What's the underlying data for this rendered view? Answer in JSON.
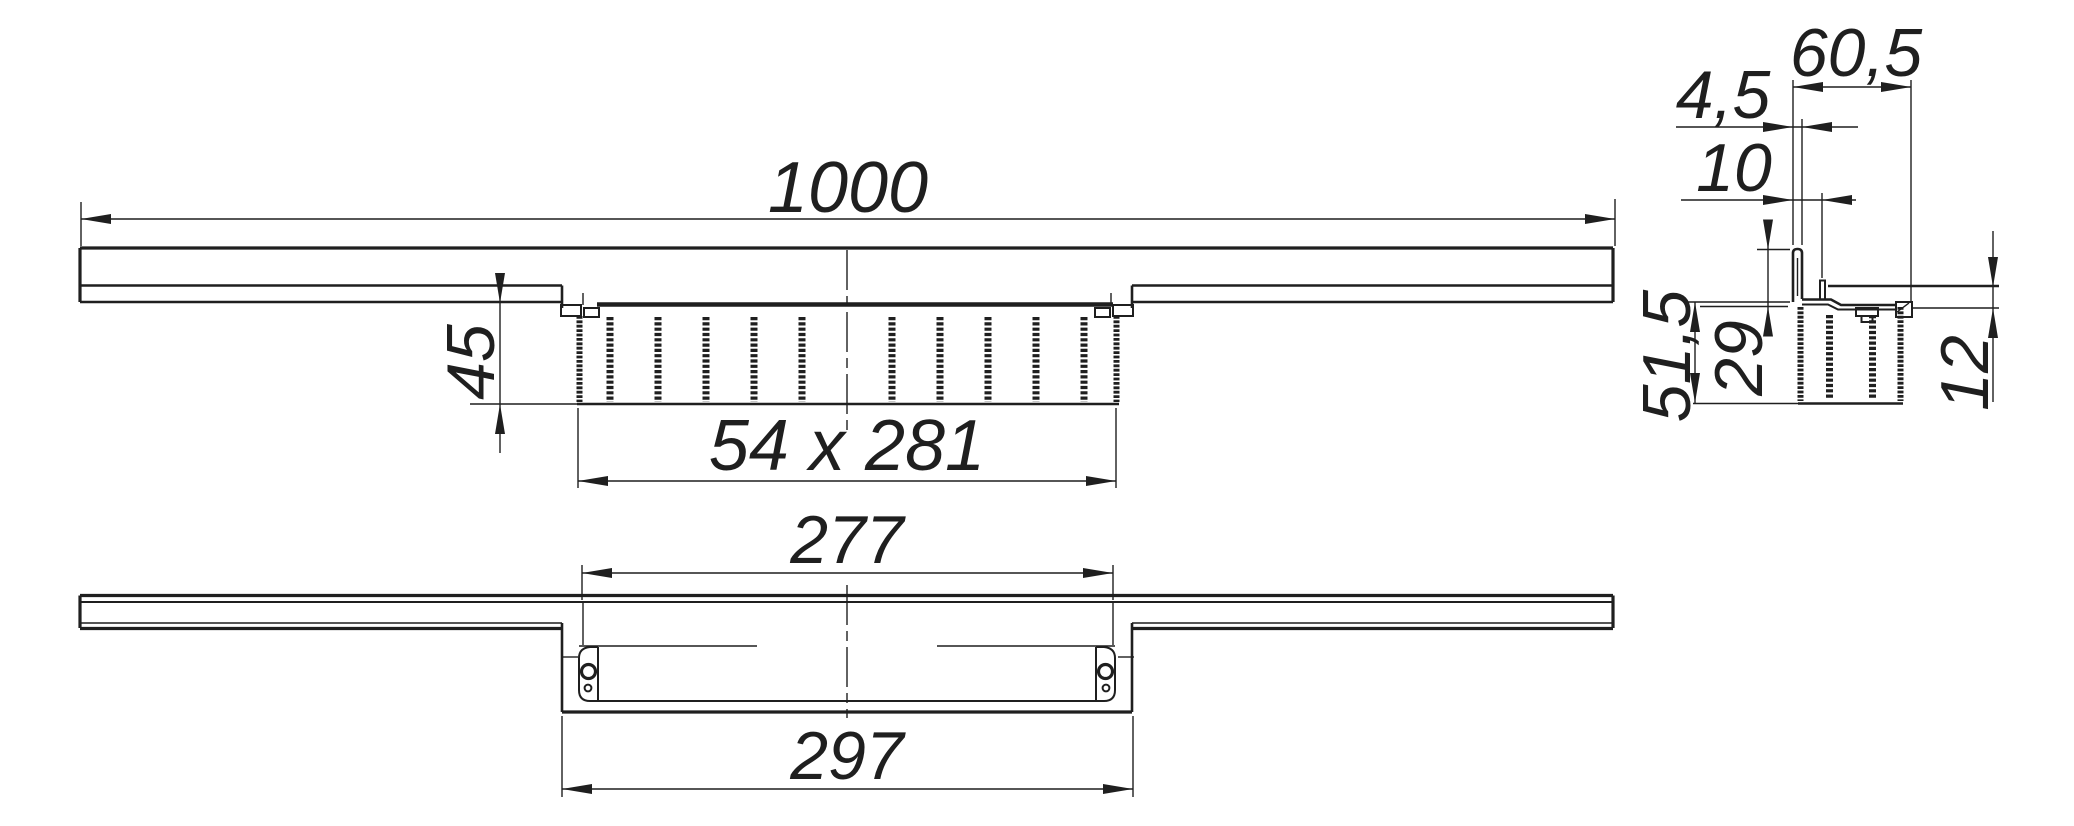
{
  "meta": {
    "background_color": "#ffffff",
    "line_color": "#1f1f1f",
    "drawing_type": "technical dimension drawing, three views of a perforated channel profile"
  },
  "views": {
    "front": {
      "title": "front-view",
      "dims": {
        "length": "1000",
        "tray_depth": "45",
        "perforation_field": "54 x 281"
      }
    },
    "bottom": {
      "title": "bottom-view",
      "dims": {
        "inner_width": "277",
        "outer_width": "297"
      }
    },
    "section": {
      "title": "side-section-view",
      "dims": {
        "flange_width": "60,5",
        "upstand_thickness": "4,5",
        "hook_offset": "10",
        "body_height": "51,5",
        "upstand_height": "29",
        "edge_drop": "12"
      }
    }
  }
}
